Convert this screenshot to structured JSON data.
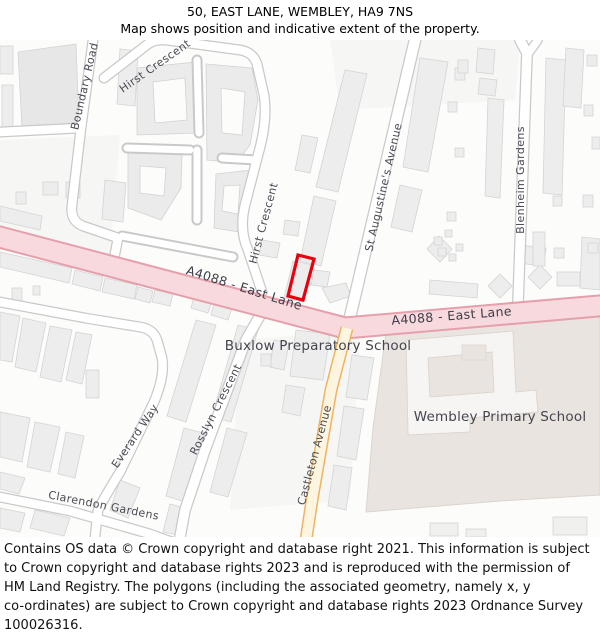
{
  "header": {
    "title": "50, EAST LANE, WEMBLEY, HA9 7NS",
    "subtitle": "Map shows position and indicative extent of the property."
  },
  "map": {
    "road_labels": {
      "boundary_road": "Boundary Road",
      "hirst_crescent_top": "Hirst Crescent",
      "hirst_crescent_right": "Hirst Crescent",
      "st_augustines_avenue": "St Augustine's Avenue",
      "blenheim_gardens": "Blenheim Gardens",
      "east_lane_west": "A4088 - East Lane",
      "east_lane_east": "A4088 - East Lane",
      "rosslyn_crescent": "Rosslyn Crescent",
      "everard_way": "Everard Way",
      "castleton_avenue": "Castleton Avenue",
      "clarendon_gardens": "Clarendon Gardens"
    },
    "place_labels": {
      "buxlow_school": "Buxlow Preparatory School",
      "wembley_school": "Wembley Primary School"
    },
    "colors": {
      "primary_road_fill": "#f7d9de",
      "primary_road_border": "#e5a0ab",
      "secondary_road_fill": "#fdf5e0",
      "secondary_road_border": "#eeb463",
      "minor_road_casing": "#c9c9c9",
      "minor_road_fill": "#ffffff",
      "building_fill": "#ededed",
      "building_border": "#d4d4d4",
      "school_ground_fill": "#eae4e0",
      "property_outline": "#e8000f",
      "street_label_color": "#4a4a54"
    }
  },
  "footer": {
    "text": "Contains OS data © Crown copyright and database right 2021. This information is subject\nto Crown copyright and database rights 2023 and is reproduced with the permission of\nHM Land Registry. The polygons (including the associated geometry, namely x, y\nco-ordinates) are subject to Crown copyright and database rights 2023 Ordnance Survey\n100026316."
  }
}
